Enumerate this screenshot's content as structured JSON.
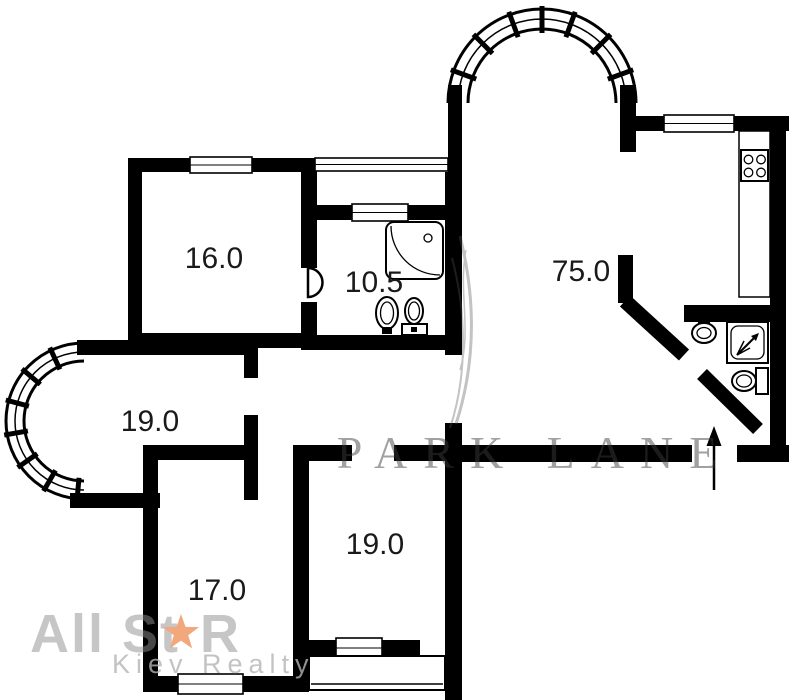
{
  "plan": {
    "type": "apartment-floor-plan",
    "rooms": [
      {
        "name": "room-top-left",
        "area_label": "16.0"
      },
      {
        "name": "bathroom",
        "area_label": "10.5"
      },
      {
        "name": "living-room-kitchen",
        "area_label": "75.0"
      },
      {
        "name": "room-left",
        "area_label": "19.0"
      },
      {
        "name": "room-bottom-left",
        "area_label": "17.0"
      },
      {
        "name": "room-bottom-middle",
        "area_label": "19.0"
      }
    ],
    "fixtures": [
      "stove",
      "kitchen-counter",
      "corner-shower",
      "toilet",
      "bidet",
      "shower-cabin",
      "wc-toilet",
      "wc-sink",
      "door-swing",
      "entrance-arrow",
      "arched-bay-window",
      "round-bay-window",
      "balcony"
    ]
  },
  "watermarks": {
    "agency_name_part1": "All St",
    "agency_name_part2": "R",
    "agency_subtitle": "Kiev Realty",
    "developer": "PARK LANE"
  },
  "colors": {
    "wall": "#000000",
    "floor": "#ffffff",
    "label": "#1a1a1a",
    "star": "#f2a87c",
    "agency_gray": "#8f8f8f",
    "subtitle_gray": "#b5b5b5",
    "developer_gray": "#3c3c3c"
  }
}
